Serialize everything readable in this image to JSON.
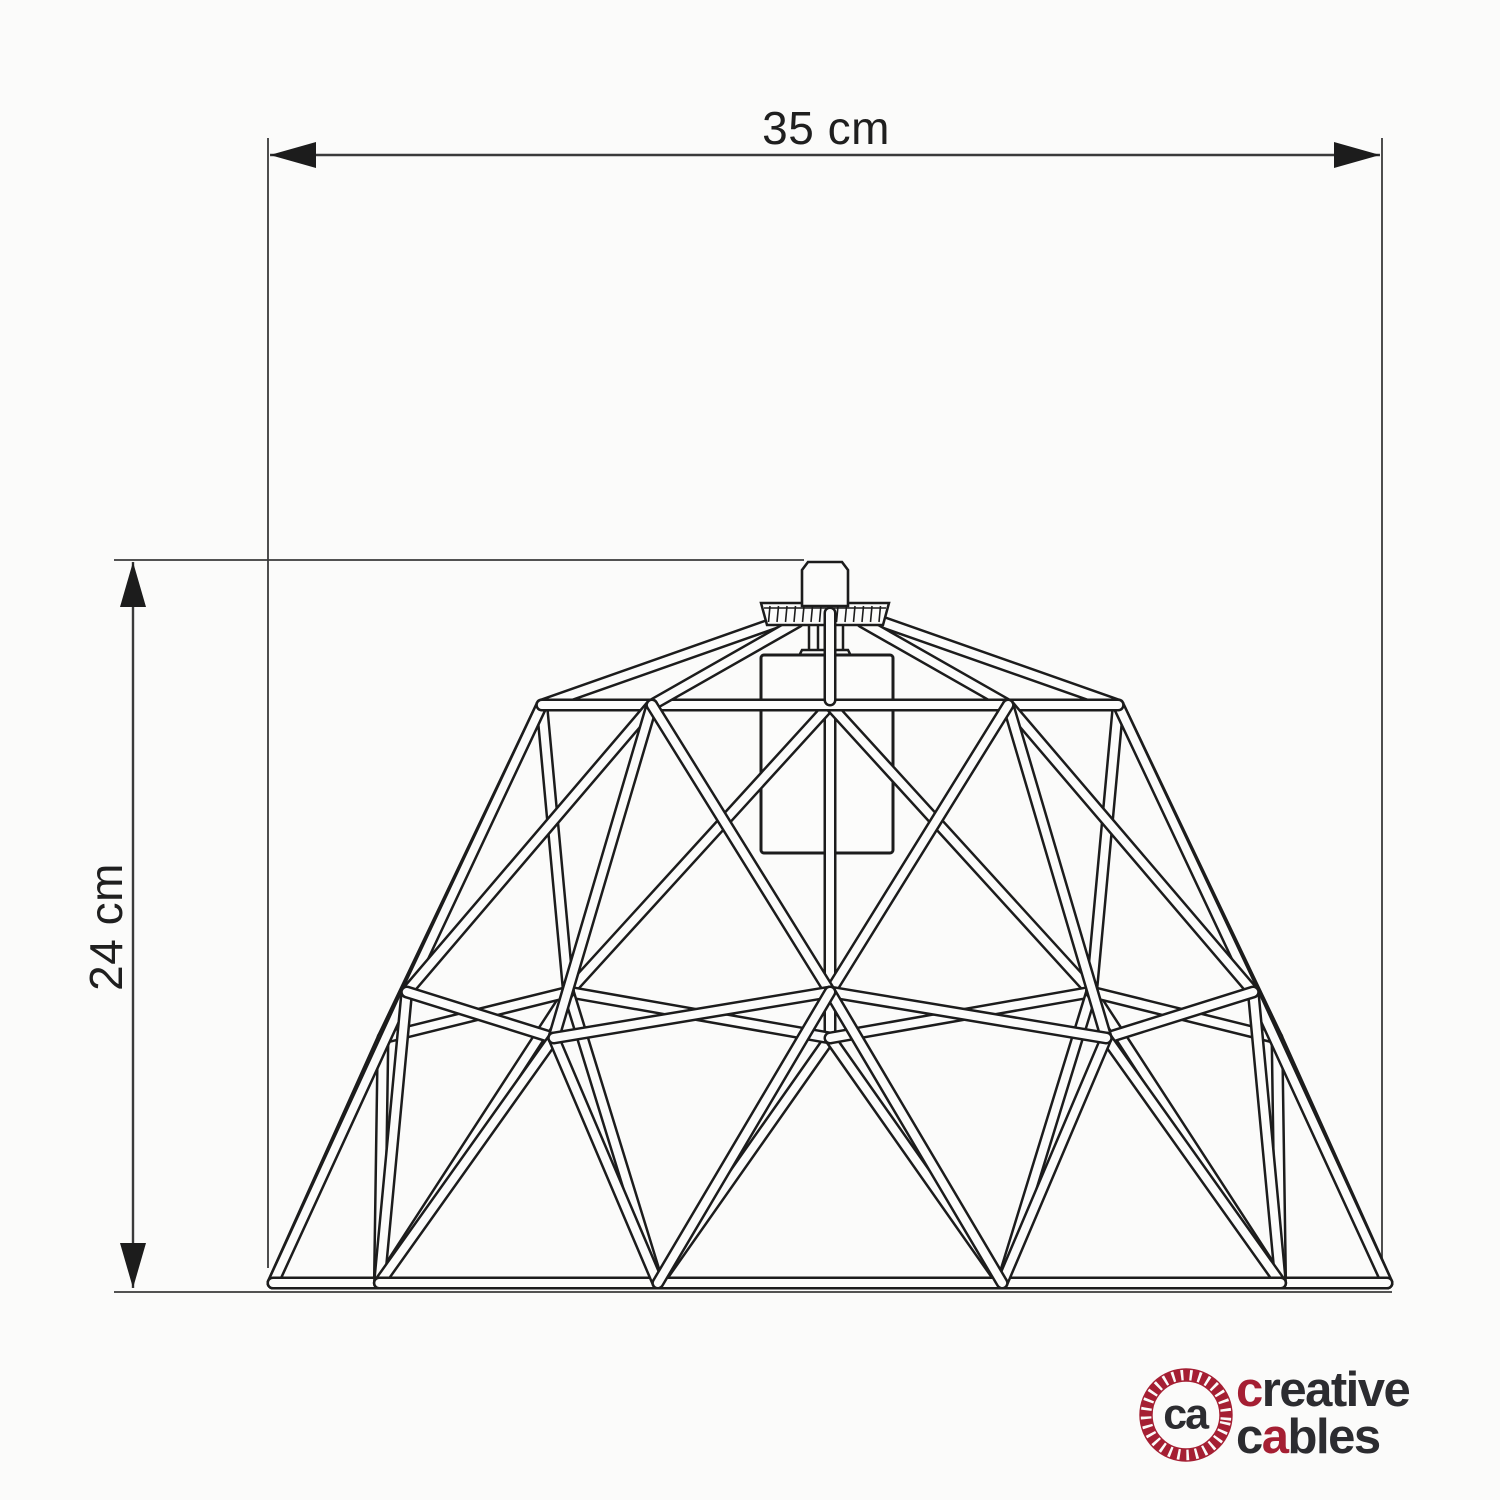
{
  "diagram": {
    "width_label": "35 cm",
    "height_label": "24 cm"
  },
  "drawing": {
    "line_color": "#1c1c1c",
    "dim_color": "#3a3a3a",
    "paper_color": "#FCFCFB"
  },
  "logo": {
    "monogram": "ca",
    "word1_accent": "c",
    "word1_rest": "reative",
    "word2_start": "c",
    "word2_accent": "a",
    "word2_rest": "bles",
    "brand_red": "#A51F33",
    "brand_dark": "#2C2C30"
  }
}
